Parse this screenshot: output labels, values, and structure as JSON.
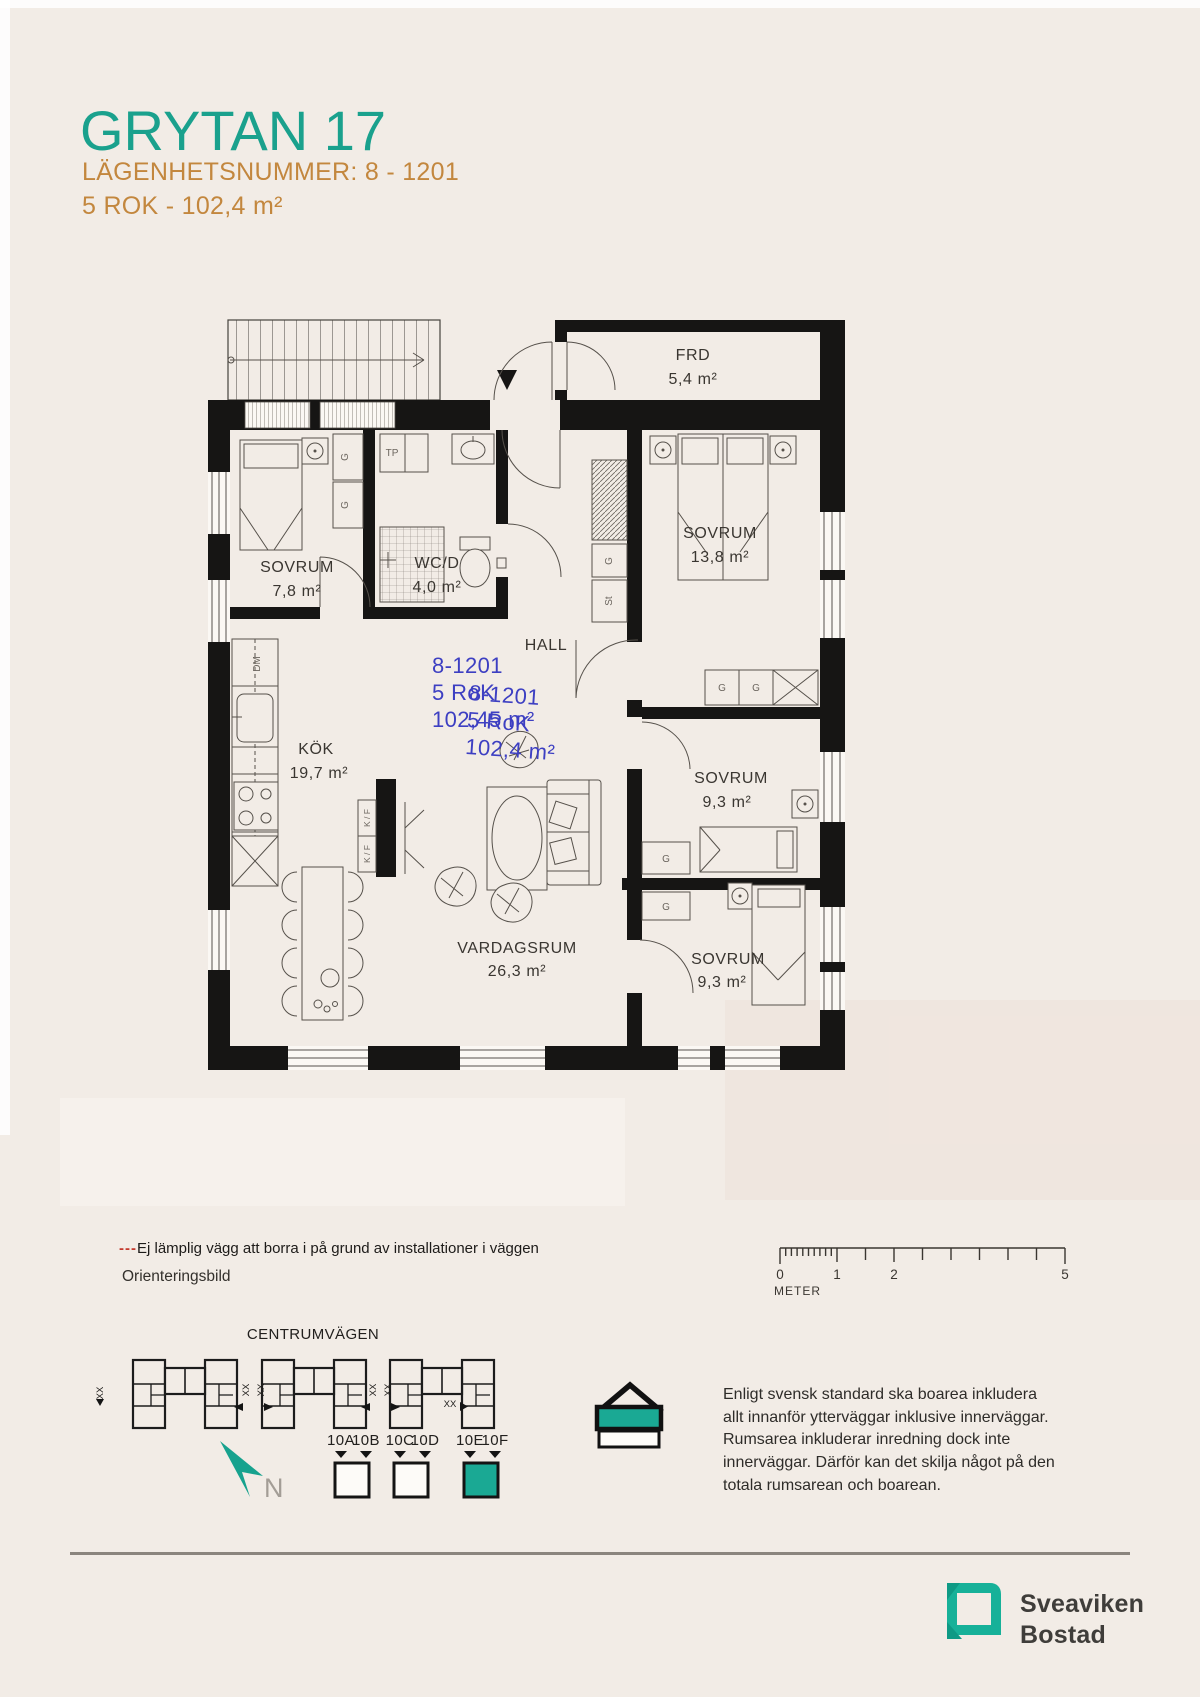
{
  "palette": {
    "teal": "#1aa18d",
    "orange": "#c3873e",
    "annotation_blue": "#3d3fc2",
    "wall_black": "#161514",
    "line_gray": "#56514b",
    "legend_red": "#c43a2e",
    "logo_teal": "#17b199",
    "background": "#f2ece6"
  },
  "header": {
    "title": "GRYTAN 17",
    "apartment": "LÄGENHETSNUMMER: 8 - 1201",
    "rooms": "5 ROK - 102,4 m²"
  },
  "plan": {
    "rooms": [
      {
        "id": "frd",
        "name": "FRD",
        "area": "5,4 m²"
      },
      {
        "id": "sovrum-1",
        "name": "SOVRUM",
        "area": "7,8 m²"
      },
      {
        "id": "wcd",
        "name": "WC/D",
        "area": "4,0 m²"
      },
      {
        "id": "hall",
        "name": "HALL",
        "area": ""
      },
      {
        "id": "sovrum-2",
        "name": "SOVRUM",
        "area": "13,8 m²"
      },
      {
        "id": "kok",
        "name": "KÖK",
        "area": "19,7 m²"
      },
      {
        "id": "sovrum-3",
        "name": "SOVRUM",
        "area": "9,3 m²"
      },
      {
        "id": "vardagsrum",
        "name": "VARDAGSRUM",
        "area": "26,3 m²"
      },
      {
        "id": "sovrum-4",
        "name": "SOVRUM",
        "area": "9,3 m²"
      }
    ],
    "fixtures": {
      "g": "G",
      "st": "St",
      "tp": "TP",
      "dm": "DM",
      "kf": "K / F"
    },
    "stamp1": {
      "line1": "8-1201",
      "line2": "5 RoK",
      "line3": "102,45 m²"
    },
    "stamp2": {
      "line1": "8-1201",
      "line2": "5 RoK",
      "line3": "102,4 m²"
    }
  },
  "legend": {
    "dashes": "---",
    "text": "Ej lämplig vägg att borra i på grund av installationer i väggen",
    "orientation_label": "Orienteringsbild"
  },
  "scalebar": {
    "t0": "0",
    "t1": "1",
    "t2": "2",
    "t5": "5",
    "unit": "METER"
  },
  "orientation": {
    "street": "CENTRUMVÄGEN",
    "xx": "XX",
    "north": "N",
    "groups": [
      {
        "left": "10A",
        "right": "10B"
      },
      {
        "left": "10C",
        "right": "10D"
      },
      {
        "left": "10E",
        "right": "10F"
      }
    ]
  },
  "note": "Enligt svensk standard ska boarea inkludera allt innanför ytterväggar inklusive innerväggar. Rumsarea inkluderar inredning dock inte innerväggar. Därför kan det skilja något på den totala rumsarean och boarean.",
  "footer": {
    "line1": "Sveaviken",
    "line2": "Bostad"
  }
}
